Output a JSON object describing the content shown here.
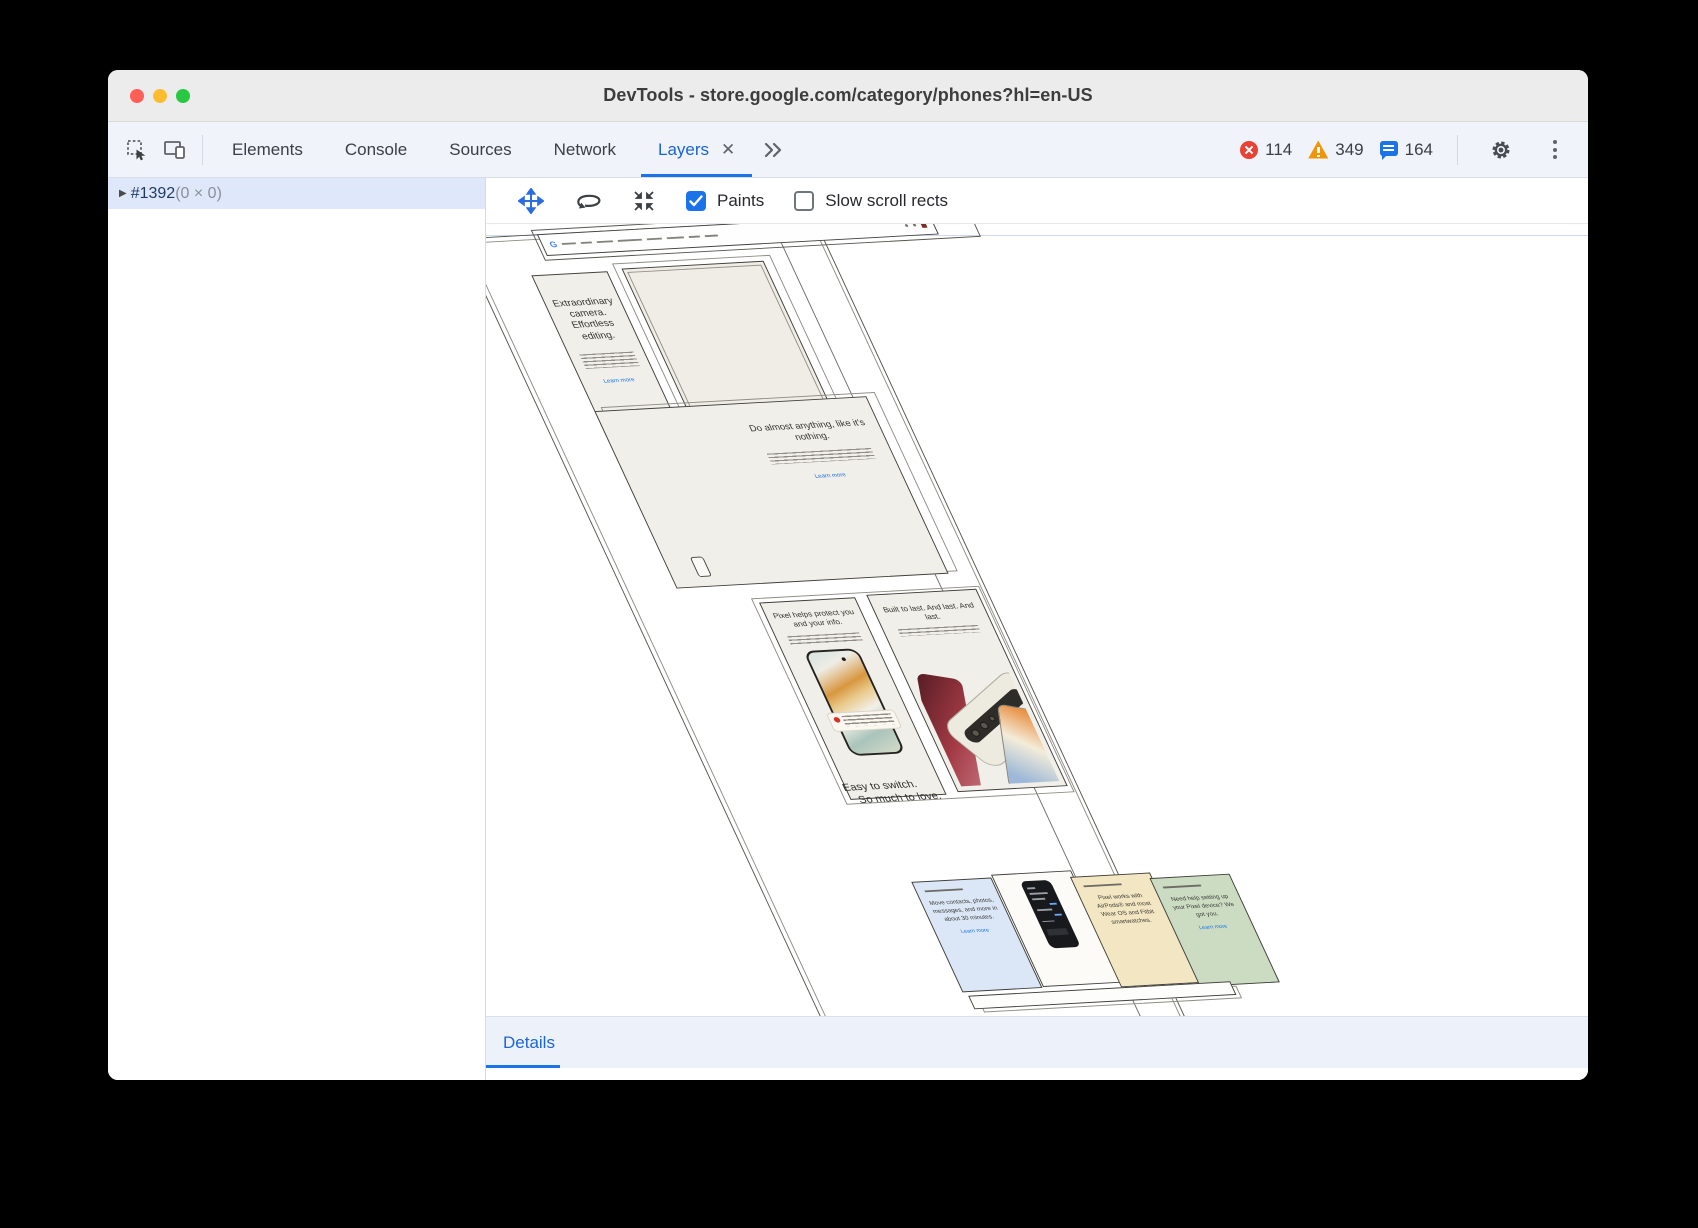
{
  "window": {
    "title": "DevTools - store.google.com/category/phones?hl=en-US"
  },
  "tabbar": {
    "tabs": [
      {
        "label": "Elements"
      },
      {
        "label": "Console"
      },
      {
        "label": "Sources"
      },
      {
        "label": "Network"
      },
      {
        "label": "Layers"
      }
    ],
    "close_glyph": "✕",
    "badges": {
      "errors": "114",
      "warnings": "349",
      "messages": "164"
    }
  },
  "sidebar": {
    "layer_id": "#1392",
    "layer_size": "(0 × 0)",
    "expander": "▶"
  },
  "layers_toolbar": {
    "paints_label": "Paints",
    "slow_scroll_label": "Slow scroll rects",
    "paints_checked": true,
    "slow_scroll_checked": false
  },
  "scene": {
    "navbar": {
      "logo": "G"
    },
    "camera_card": {
      "heading": "Extraordinary camera. Effortless editing.",
      "link": "Learn more"
    },
    "anything_card": {
      "heading": "Do almost anything, like it's nothing.",
      "link": "Learn more"
    },
    "protect_card": {
      "heading": "Pixel helps protect you and your info."
    },
    "built_card": {
      "heading": "Built to last. And last. And last."
    },
    "switch_heading": {
      "line1": "Easy to switch.",
      "line2": "So much to love."
    },
    "switch_blue_card": {
      "body": "Move contacts, photos, messages, and more in about 30 minutes.",
      "link": "Learn more"
    },
    "switch_tan_card": {
      "body": "Pixel works with AirPods® and most Wear OS and Fitbit smartwatches."
    },
    "switch_green_card": {
      "body": "Need help setting up your Pixel device? We got you.",
      "link": "Learn more"
    }
  },
  "details": {
    "label": "Details"
  },
  "colors": {
    "accent": "#1a73e8",
    "active_tab": "#1a63d9",
    "error": "#e94235",
    "warning": "#f09409",
    "selection_row": "#dfe8fb",
    "card_beige": "#f1efe9",
    "card_blue": "#dbe7f7",
    "card_tan": "#f3e7c3",
    "card_green": "#ccdcc3",
    "titlebar": "#ececec",
    "tabbar_bg": "#f0f3fa"
  }
}
